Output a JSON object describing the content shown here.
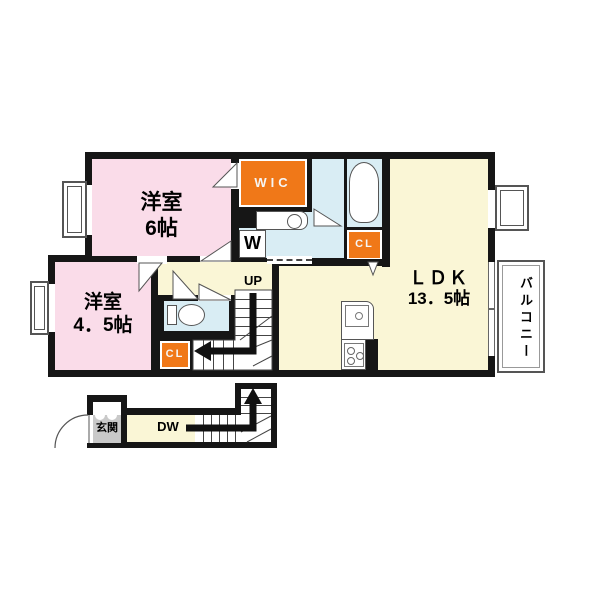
{
  "rooms": {
    "bedroom6": {
      "name": "洋室",
      "size": "6帖"
    },
    "bedroom45": {
      "name": "洋室",
      "size": "4．5帖"
    },
    "ldk": {
      "name": "ＬＤＫ",
      "size": "13．5帖"
    },
    "wic": "WIC",
    "closet_bath": "CL",
    "closet_hall": "CL",
    "washer": "W",
    "entrance": "玄関",
    "balcony": "バルコニー"
  },
  "stairs": {
    "up": "UP",
    "down": "DW"
  },
  "colors": {
    "wall": "#161616",
    "bedroom_pink": "#FADCE9",
    "ldk_cream": "#FAF6D6",
    "wet_area_blue": "#D9EDF4",
    "closet_orange": "#F07818",
    "entrance_gray": "#C9C9C9",
    "background": "#FFFFFF"
  }
}
